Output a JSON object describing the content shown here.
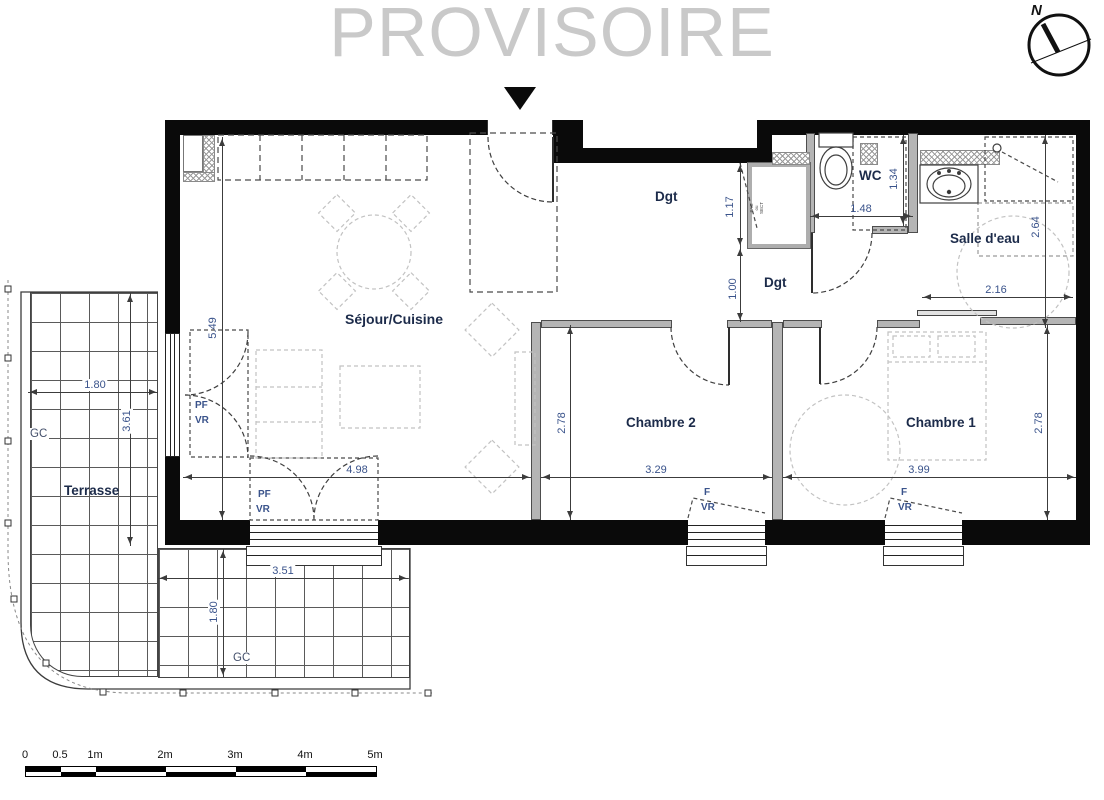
{
  "watermark": "PROVISOIRE",
  "compass": {
    "north": "N"
  },
  "rooms": {
    "sejour": "Séjour/Cuisine",
    "dgt_upper": "Dgt",
    "dgt_lower": "Dgt",
    "wc": "WC",
    "salle_deau": "Salle d'eau",
    "chambre2": "Chambre 2",
    "chambre1": "Chambre 1",
    "terrasse": "Terrasse"
  },
  "annotations": {
    "gc_left": "GC",
    "gc_bottom": "GC",
    "pac_lines": [
      "PAC",
      "ou",
      "SECT"
    ],
    "left_window": {
      "l1": "PF",
      "l2": "VR"
    },
    "sejour_window": {
      "l1": "PF",
      "l2": "VR"
    },
    "ch2_window": {
      "l1": "F",
      "l2": "VR"
    },
    "ch1_window": {
      "l1": "F",
      "l2": "VR"
    }
  },
  "dims": {
    "sejour_h": "5.49",
    "sejour_w": "4.98",
    "ch2_w": "3.29",
    "ch1_w": "3.99",
    "ch2_h": "2.78",
    "ch1_h": "2.78",
    "hall_upper": "1.17",
    "hall_lower": "1.00",
    "wc_w": "1.48",
    "wc_h": "1.34",
    "sde_h": "2.64",
    "sde_w": "2.16",
    "terrace_left_w": "1.80",
    "terrace_left_h": "3.61",
    "terrace_bottom_w": "3.51",
    "terrace_bottom_h": "1.80"
  },
  "scale_bar": {
    "ticks": [
      "0",
      "0.5",
      "1m",
      "2m",
      "3m",
      "4m",
      "5m"
    ]
  },
  "colors": {
    "wall": "#0a0a0a",
    "room_label": "#1c2b4a",
    "dim_label": "#3a538b",
    "watermark": "#c9c9c9",
    "furniture": "#c2c2c2"
  }
}
